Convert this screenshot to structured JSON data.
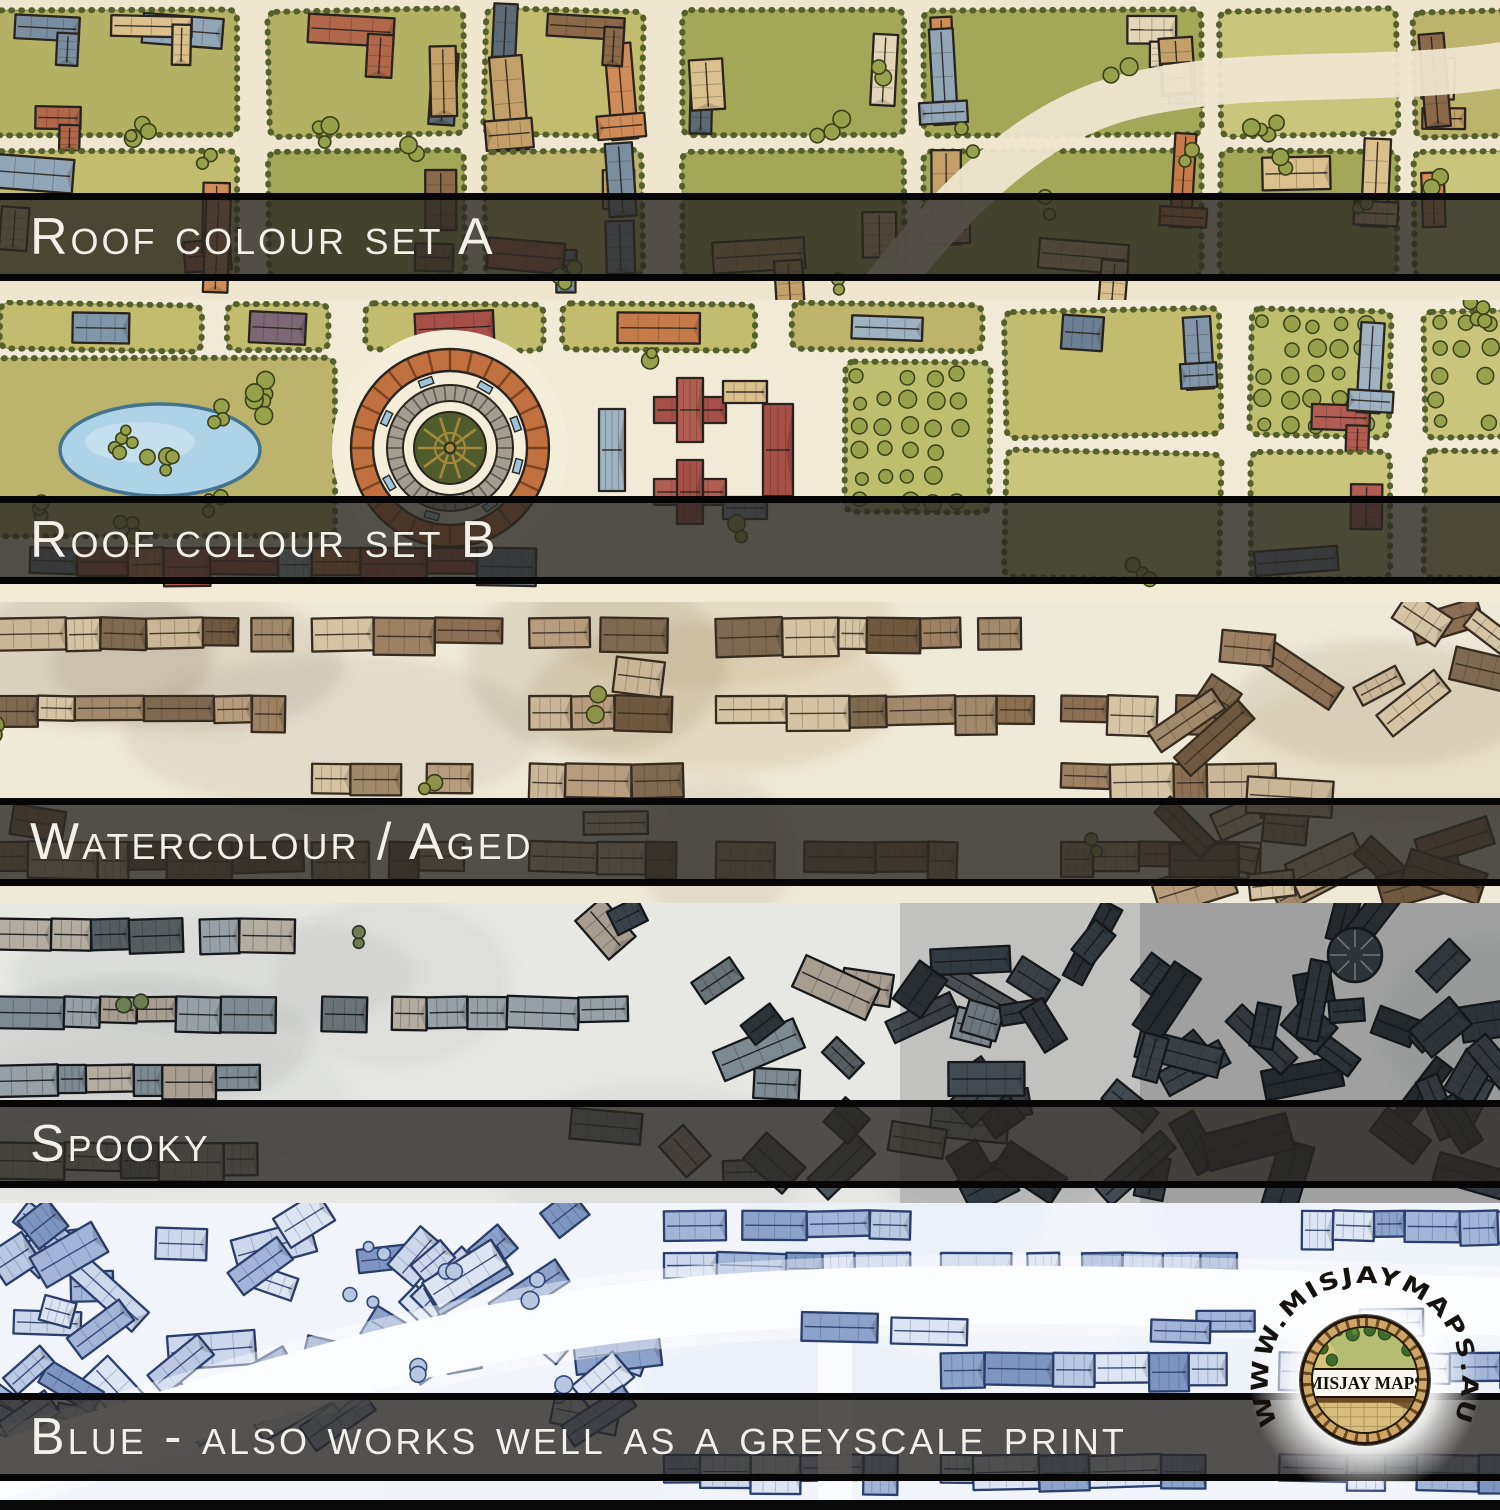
{
  "image": {
    "description": "Preview of five colour variants of a hand-drawn fantasy city battle map, stacked as horizontal strips with dark label bars",
    "brand": "Misjay Maps"
  },
  "bands": [
    {
      "id": "roof-colour-set-a",
      "label": "Roof colour set A",
      "style": "green",
      "seed": 11,
      "palette": {
        "ground": "#efe6d0",
        "blocks": [
          "#b2b164",
          "#c2bc6e",
          "#a2a857",
          "#bcb46c"
        ],
        "fields": [
          "#c9c57c",
          "#d2cc88",
          "#bdbf6e"
        ],
        "hedge": "#55602a",
        "tree": "#97a14c",
        "tree_dark": "#39411b",
        "line": "#2a241e",
        "roofs": [
          "#c57b49",
          "#d08c58",
          "#92a6b8",
          "#7a8ea2",
          "#d9c08d",
          "#8a6a48",
          "#5d6b76",
          "#c3a069",
          "#e2d6b6",
          "#b0674a"
        ]
      }
    },
    {
      "id": "roof-colour-set-b",
      "label": "Roof colour set B",
      "style": "greenb",
      "seed": 22,
      "palette": {
        "ground": "#f1ead6",
        "blocks": [
          "#b2b164",
          "#c2bc6e",
          "#a2a857",
          "#bcb46c"
        ],
        "fields": [
          "#c9c57c",
          "#d2cc88",
          "#bdbf6e"
        ],
        "hedge": "#55602a",
        "tree": "#97a14c",
        "tree_dark": "#39411b",
        "line": "#2a241e",
        "roofs": [
          "#9fb2c2",
          "#8296a9",
          "#a65048",
          "#b25d51",
          "#7d6876",
          "#d9c08d",
          "#c57b49",
          "#e3d9c1",
          "#6d7f92"
        ],
        "pond": "#aed3e6",
        "pond_line": "#44738f",
        "plaza": "#f3edda",
        "arena_ring": "#c1713f",
        "arena_ring_dark": "#7e441f",
        "arena_stone": "#a49d92",
        "arena_stone_dark": "#5f594e",
        "arena_garden": "#515c2c",
        "arena_gold": "#a58a3c",
        "bench": "#9cc4dc"
      }
    },
    {
      "id": "watercolour-aged",
      "label": "Watercolour / Aged",
      "style": "sepia",
      "seed": 33,
      "palette": {
        "ground": "#efe9d8",
        "wash": [
          "#b08a55",
          "#8a7a5a",
          "#74604a"
        ],
        "tree": "#8d9348",
        "tree_dark": "#3a3d1d",
        "line": "#362c20",
        "roofs": [
          "#9c8263",
          "#8a6f52",
          "#b59d7e",
          "#6e5940",
          "#c9b696",
          "#a18a6b",
          "#7d6a50",
          "#d4c4a4"
        ]
      }
    },
    {
      "id": "spooky",
      "label": "Spooky",
      "style": "dark",
      "seed": 44,
      "palette": {
        "ground": "#e7e7e4",
        "wash": [
          "#9aa0a0",
          "#7b8284",
          "#585f62"
        ],
        "tree": "#6e7c52",
        "tree_dark": "#2b3322",
        "line": "#16191b",
        "roofs": [
          "#a89d91",
          "#96a0a6",
          "#7e8a91",
          "#6a7378",
          "#565d61",
          "#b3aca1"
        ],
        "dark_roofs": [
          "#39424a",
          "#2e3539",
          "#4c565e",
          "#424a50",
          "#343b40"
        ]
      }
    },
    {
      "id": "blue",
      "label": "Blue - also works well as a greyscale print",
      "style": "blue",
      "seed": 55,
      "palette": {
        "ground": "#f1f4fa",
        "wash": [
          "#dce5f3",
          "#cfdaed"
        ],
        "tree": "#b8c6e0",
        "tree_dark": "#32497e",
        "line": "#2b3e6d",
        "roofs": [
          "#bac8e3",
          "#a2b4d8",
          "#8da2cb",
          "#ccd7ec",
          "#7e95c1",
          "#dde5f4"
        ],
        "road": "#fcfdff"
      }
    }
  ],
  "dividers": {
    "bar_color": "rgba(43,40,36,0.8)",
    "line_color": "#060606",
    "label_color": "#f3f0ea"
  },
  "logo": {
    "arc_text": "WWW.MISJAYMAPS.AU",
    "name": "MISJAY MAPS",
    "colors": {
      "arc_text": "#15110c",
      "brick": "#cfa668",
      "brick_dark": "#6b4a22",
      "field": "#b5bd74",
      "tree": "#3e6a2c",
      "tree_light": "#5d8a3a",
      "path": "#d9c37c",
      "band_bg": "#f8f6ef",
      "band_text": "#12100a",
      "cobble": "#d9bd7d",
      "cobble_line": "#8a7340",
      "glow": "#ffffff"
    }
  }
}
